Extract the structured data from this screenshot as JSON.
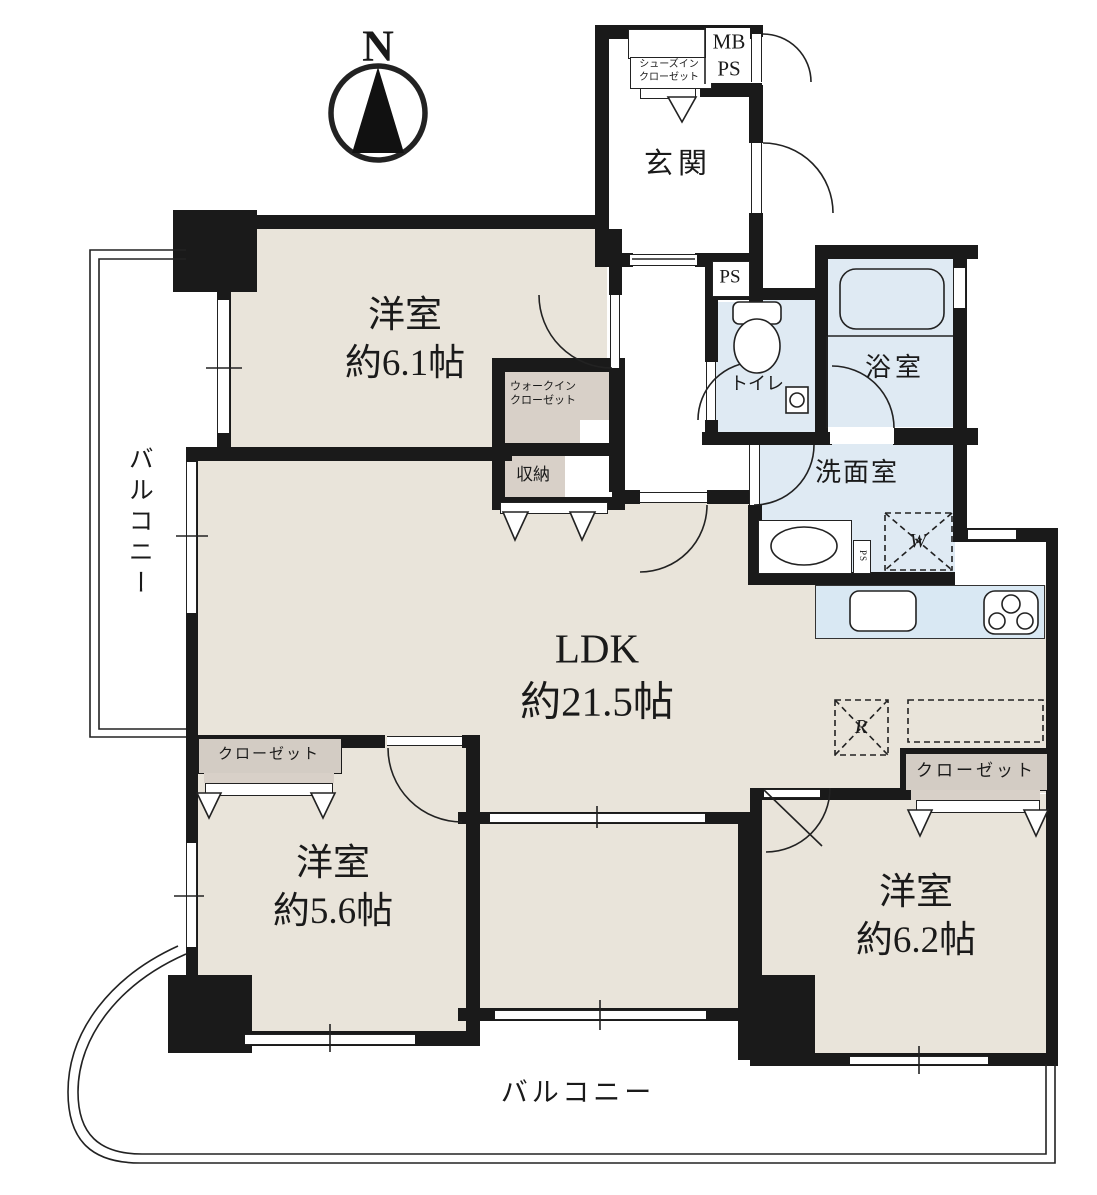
{
  "compass": {
    "label": "N"
  },
  "balconies": {
    "left": {
      "label": "バルコニー"
    },
    "bottom": {
      "label": "バルコニー"
    }
  },
  "rooms": {
    "entrance": {
      "label": "玄関"
    },
    "bedroom_nw": {
      "label": "洋室\n約6.1帖"
    },
    "ldk": {
      "label": "LDK\n約21.5帖"
    },
    "bedroom_sw": {
      "label": "洋室\n約5.6帖"
    },
    "bedroom_se": {
      "label": "洋室\n約6.2帖"
    },
    "toilet": {
      "label": "トイレ"
    },
    "bathroom": {
      "label": "浴室"
    },
    "washroom": {
      "label": "洗面室"
    }
  },
  "storage": {
    "shoes_in_closet": {
      "label": "シューズイン\nクローゼット"
    },
    "walk_in_closet": {
      "label": "ウォークイン\nクローゼット"
    },
    "storage_box": {
      "label": "収納"
    },
    "closet_sw": {
      "label": "クローゼット"
    },
    "closet_se": {
      "label": "クローゼット"
    }
  },
  "utility": {
    "mb_ps": {
      "label": "MB\nPS"
    },
    "ps_upper": {
      "label": "PS"
    },
    "ps_small": {
      "label": "PS"
    }
  },
  "appliances": {
    "washer_mark": {
      "label": "W"
    },
    "fridge_mark": {
      "label": "R"
    }
  },
  "colors": {
    "wall": "#1a1a1a",
    "room_beige": "#e9e4da",
    "closet_gray": "#d8d0c8",
    "wet_area_blue": "#dfeaf3",
    "kitchen_blue": "#d9e8f3",
    "line": "#222222"
  }
}
